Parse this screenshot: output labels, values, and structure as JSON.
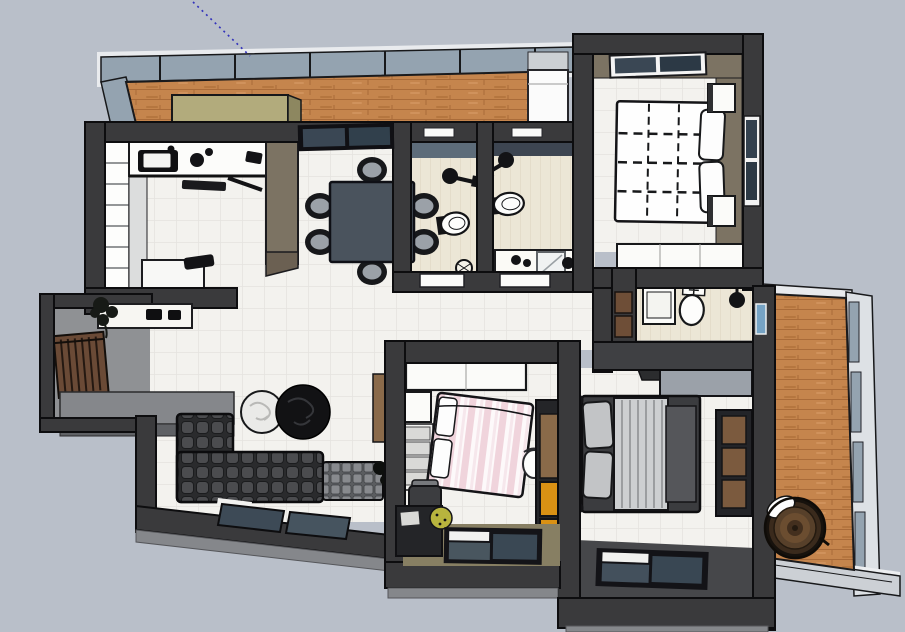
{
  "scene": {
    "type": "3d-floorplan-top-view",
    "renderer": "sketchup-style-viewport",
    "canvas": {
      "width": 905,
      "height": 632
    },
    "annotations": {
      "axis_guide": "dotted-blue-inference-line"
    }
  },
  "colors": {
    "background": "#b9bfc9",
    "outline": "#0d0d0f",
    "wall": "#3a3a3c",
    "wallLight": "#85878b",
    "wallFace": "#46474a",
    "taupe": "#7c7363",
    "khaki": "#877f63",
    "tile": "#f3f2ee",
    "tileLine": "#e4e3df",
    "bath": "#ece6d6",
    "wood": "#c5854d",
    "woodLine": "#a96b39",
    "glass": "#94a3b0",
    "glassDark": "#3a4754",
    "chest": "#b2ab7c",
    "chestDark": "#8d8760",
    "fence": "#6a4a36",
    "entryFloor": "#8f9194",
    "sofa": "#2a2b2d",
    "sofaTuft": "#4b4c4f",
    "ottoman": "#5b5d60",
    "ottomanTuft": "#888a8e",
    "rugWhite": "#eaeae8",
    "rugBlack": "#121214",
    "pink": "#f0d4dc",
    "pinkLight": "#fdf9fa",
    "orange": "#d99114",
    "woodCab": "#8a6a49",
    "blanket": "#cdcfd1",
    "bedDark": "#3b3c3f",
    "deskGray": "#9ba1a9",
    "axis": "#3333bb",
    "white": "#fbfbf9",
    "black": "#131316",
    "barrel": "#57402a"
  },
  "rooms": [
    {
      "id": "laundry-balcony",
      "label": "laundry balcony",
      "furniture": [
        "glass-railing",
        "wood-deck",
        "storage-chest",
        "washing-machine"
      ]
    },
    {
      "id": "kitchen",
      "label": "kitchen",
      "furniture": [
        "tall-cabinet-column",
        "counter-with-sink",
        "cooktop-items",
        "kitchen-island",
        "taupe-partition"
      ]
    },
    {
      "id": "dining-area",
      "label": "dining area",
      "furniture": [
        "window",
        "dining-table",
        "dining-chairs-x6"
      ]
    },
    {
      "id": "bathroom-1",
      "label": "bathroom 1",
      "furniture": [
        "window-slit",
        "shower-head",
        "toilet",
        "floor-drain",
        "door-slab"
      ]
    },
    {
      "id": "bathroom-2",
      "label": "bathroom 2",
      "furniture": [
        "window-slit",
        "shower-head",
        "toilet",
        "vanity-with-mirror",
        "door-slab"
      ]
    },
    {
      "id": "master-bedroom",
      "label": "master bedroom",
      "furniture": [
        "top-window",
        "right-window",
        "plaid-double-bed",
        "pillows",
        "nightstand-x2",
        "dresser"
      ]
    },
    {
      "id": "ensuite-bathroom",
      "label": "ensuite bathroom",
      "furniture": [
        "sink",
        "toilet",
        "shower-head",
        "small-window",
        "counter",
        "wall-panels"
      ]
    },
    {
      "id": "bedroom-2",
      "label": "bedroom 2 pink",
      "furniture": [
        "wardrobe",
        "nightstand",
        "headboard-cushions",
        "pink-striped-bed",
        "white-chair",
        "cabinet-orange-drawers",
        "desk",
        "desk-chair",
        "plant",
        "window"
      ]
    },
    {
      "id": "bedroom-3",
      "label": "bedroom 3 gray",
      "furniture": [
        "corner-desk",
        "gray-double-bed",
        "pillows",
        "striped-blanket",
        "shelf-wardrobe",
        "wall-lamps",
        "window"
      ]
    },
    {
      "id": "living-room",
      "label": "living room",
      "furniture": [
        "sectional-sofa",
        "ottoman",
        "round-rug-white",
        "round-rug-black",
        "floor-plant",
        "tv-wood-panel",
        "low-windows"
      ]
    },
    {
      "id": "entry-porch",
      "label": "entry porch",
      "furniture": [
        "slatted-fence",
        "console-shelf",
        "plant",
        "step-platform"
      ]
    },
    {
      "id": "right-balcony",
      "label": "right balcony",
      "furniture": [
        "glass-railing",
        "wood-deck",
        "round-basket"
      ]
    }
  ]
}
